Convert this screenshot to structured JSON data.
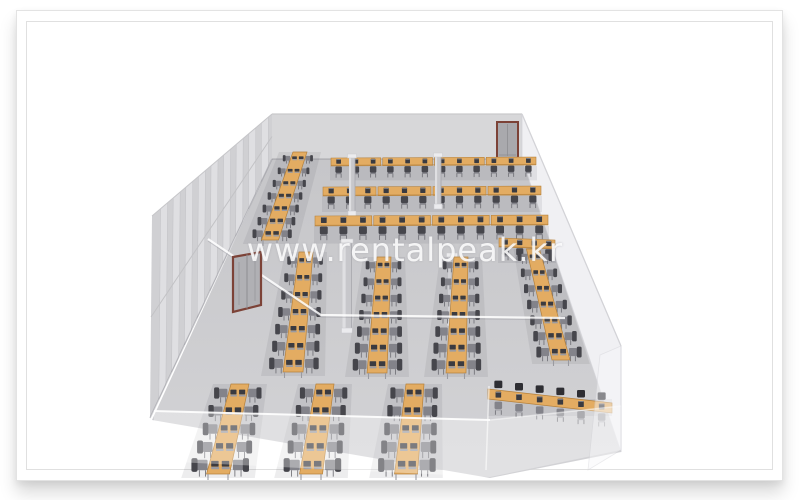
{
  "watermark": {
    "text": "www.rentalpeak.kr"
  },
  "colors": {
    "desk": "#e3ac62",
    "desk_edge": "#b5813c",
    "laptop": "#3b3b40",
    "laptop_lite": "#9b9ba1",
    "chair_dark": "#46464c",
    "chair_mid": "#83838a",
    "chair_light": "#a9a9af",
    "chair_leg": "#74747a",
    "chair_black": "#2e2e33",
    "pillar": "#c7c7cb",
    "pillar_hi": "#dfdfe2",
    "pillar_edge": "#a8a8ad",
    "wall_back": "#d7d7d9",
    "wall_left": "#d0d0d3",
    "panel": "#dfdfe2",
    "panel_edge": "#c2c2c6",
    "floor_a": "#c6c6c9",
    "floor_b": "#d3d3d6",
    "glass": "#ededf1",
    "glass_edge": "#d2d2d7",
    "door_frame": "#7c4237",
    "door_panel": "#a9a9ad",
    "door_line": "#8e8e92",
    "line_white": "rgba(255,255,255,0.85)",
    "row_shadow": "rgba(75,75,85,0.10)",
    "wall_line": "rgba(110,110,118,0.30)"
  },
  "room": {
    "floor": [
      [
        272,
        159
      ],
      [
        522,
        159
      ],
      [
        621,
        452
      ],
      [
        490,
        478
      ],
      [
        152,
        420
      ]
    ],
    "back_wall": [
      [
        272,
        114
      ],
      [
        522,
        114
      ],
      [
        522,
        159
      ],
      [
        272,
        159
      ]
    ],
    "left_wall": {
      "top_back": [
        272,
        114
      ],
      "top_front": [
        152,
        216
      ],
      "base_front": [
        150,
        418
      ],
      "base_back": [
        272,
        159
      ],
      "panels": 9
    },
    "right_glass": [
      [
        522,
        114
      ],
      [
        621,
        346
      ],
      [
        621,
        452
      ],
      [
        522,
        159
      ]
    ],
    "right_glass_front": [
      [
        600,
        355
      ],
      [
        621,
        346
      ],
      [
        621,
        450
      ],
      [
        588,
        470
      ]
    ],
    "front_glass": [
      [
        154,
        411
      ],
      [
        490,
        420
      ],
      [
        621,
        406
      ],
      [
        621,
        450
      ],
      [
        490,
        477
      ],
      [
        154,
        461
      ]
    ],
    "front_glass_edge": [
      [
        154,
        411
      ],
      [
        490,
        420
      ]
    ],
    "partition_line": [
      [
        208,
        239
      ],
      [
        321,
        315
      ],
      [
        565,
        318
      ]
    ],
    "alcove_edge": [
      [
        489,
        386
      ],
      [
        486,
        470
      ]
    ],
    "door_back": {
      "x": 497,
      "y": 122,
      "w": 21,
      "h": 36
    },
    "door_left": [
      [
        233,
        257
      ],
      [
        261,
        252
      ],
      [
        261,
        305
      ],
      [
        233,
        312
      ]
    ],
    "pillars": [
      {
        "x": 352,
        "y": 157,
        "w": 6,
        "h": 57
      },
      {
        "x": 438,
        "y": 156,
        "w": 6,
        "h": 51
      },
      {
        "x": 347,
        "y": 242,
        "w": 9,
        "h": 89
      },
      {
        "x": 452,
        "y": 256,
        "w": 8,
        "h": 68
      }
    ]
  },
  "furniture": [
    {
      "kind": "hrow",
      "name": "back-row-1",
      "x1": 330,
      "y1": 158,
      "x2": 537,
      "y2": 157,
      "depth": 8,
      "seats": 12,
      "chair": 9,
      "segs": 4
    },
    {
      "kind": "hrow",
      "name": "back-row-2",
      "x1": 322,
      "y1": 187,
      "x2": 542,
      "y2": 186,
      "depth": 9,
      "seats": 12,
      "chair": 10,
      "segs": 4
    },
    {
      "kind": "hrow",
      "name": "back-row-3",
      "x1": 314,
      "y1": 216,
      "x2": 549,
      "y2": 215,
      "depth": 10,
      "seats": 12,
      "chair": 11,
      "segs": 4
    },
    {
      "kind": "hrow",
      "name": "back-row-4",
      "x1": 498,
      "y1": 238,
      "x2": 556,
      "y2": 240,
      "depth": 9,
      "seats": 4,
      "chair": 10,
      "segs": 1
    },
    {
      "kind": "vrow",
      "name": "diagonal-row",
      "x1": 300,
      "y1": 152,
      "x2": 270,
      "y2": 240,
      "wTop": 14,
      "wBot": 17,
      "seats": 7,
      "cTop": 6,
      "cBot": 9
    },
    {
      "kind": "vrow",
      "name": "mid-row-1",
      "x1": 306,
      "y1": 252,
      "x2": 293,
      "y2": 372,
      "wTop": 14,
      "wBot": 20,
      "seats": 7,
      "cTop": 8,
      "cBot": 12
    },
    {
      "kind": "vrow",
      "name": "mid-row-2",
      "x1": 384,
      "y1": 257,
      "x2": 377,
      "y2": 373,
      "wTop": 14,
      "wBot": 20,
      "seats": 7,
      "cTop": 8,
      "cBot": 12
    },
    {
      "kind": "vrow",
      "name": "mid-row-3",
      "x1": 461,
      "y1": 257,
      "x2": 456,
      "y2": 373,
      "wTop": 14,
      "wBot": 20,
      "seats": 7,
      "cTop": 8,
      "cBot": 12
    },
    {
      "kind": "vrow",
      "name": "mid-row-4",
      "x1": 533,
      "y1": 249,
      "x2": 561,
      "y2": 360,
      "wTop": 13,
      "wBot": 18,
      "seats": 7,
      "cTop": 8,
      "cBot": 11
    },
    {
      "kind": "vrow",
      "name": "front-row-1",
      "x1": 240,
      "y1": 384,
      "x2": 218,
      "y2": 474,
      "wTop": 18,
      "wBot": 23,
      "seats": 5,
      "cTop": 11,
      "cBot": 14
    },
    {
      "kind": "vrow",
      "name": "front-row-2",
      "x1": 325,
      "y1": 384,
      "x2": 311,
      "y2": 474,
      "wTop": 18,
      "wBot": 23,
      "seats": 5,
      "cTop": 11,
      "cBot": 14
    },
    {
      "kind": "vrow",
      "name": "front-row-3",
      "x1": 415,
      "y1": 384,
      "x2": 406,
      "y2": 474,
      "wTop": 18,
      "wBot": 23,
      "seats": 5,
      "cTop": 11,
      "cBot": 14
    },
    {
      "kind": "alcove",
      "name": "alcove-row",
      "x1": 488,
      "y1": 389,
      "x2": 612,
      "y2": 403,
      "depth": 10,
      "seats": 6,
      "chair": 10
    }
  ]
}
